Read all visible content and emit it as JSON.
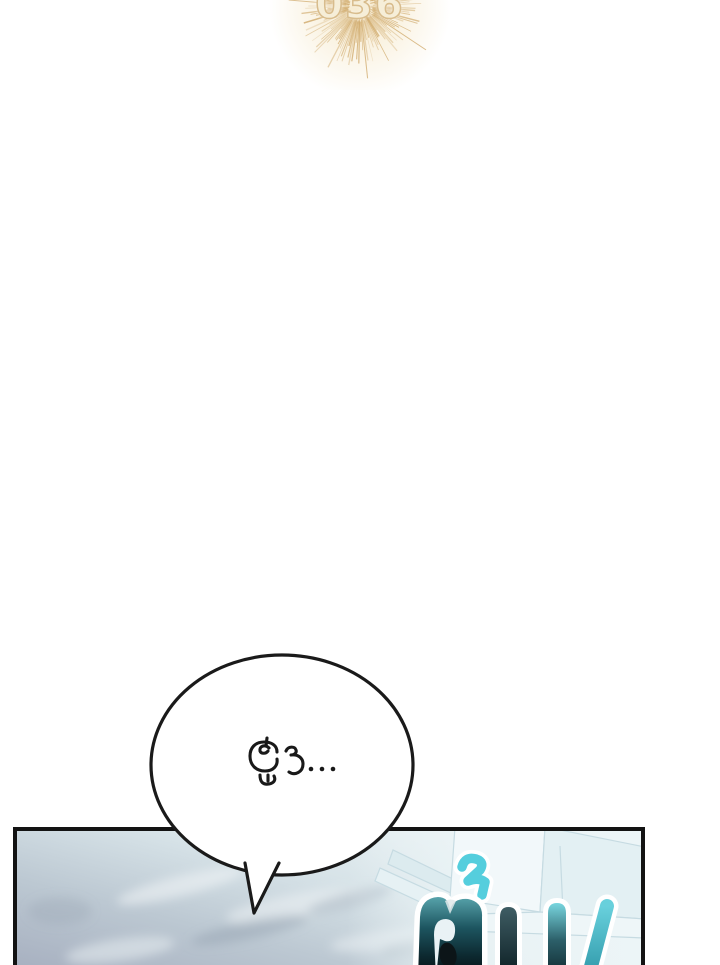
{
  "chapter_badge": {
    "number": "036"
  },
  "speech_bubble": {
    "text": "ฮู่ว...",
    "fill": "#ffffff",
    "outline": "#1a1a1a"
  },
  "panel": {
    "sfx_text": "ตื่น!!",
    "border_color": "#131313"
  },
  "colors": {
    "ray_gold": "#cfa868",
    "digit_fill": "#f6eed8",
    "digit_outline": "#d8bc8c",
    "sfx_cyan": "#55cedd",
    "sfx_dark": "#0a1c21",
    "scene_blue_gray": "#aab3c3",
    "scene_light": "#eef5f6"
  }
}
